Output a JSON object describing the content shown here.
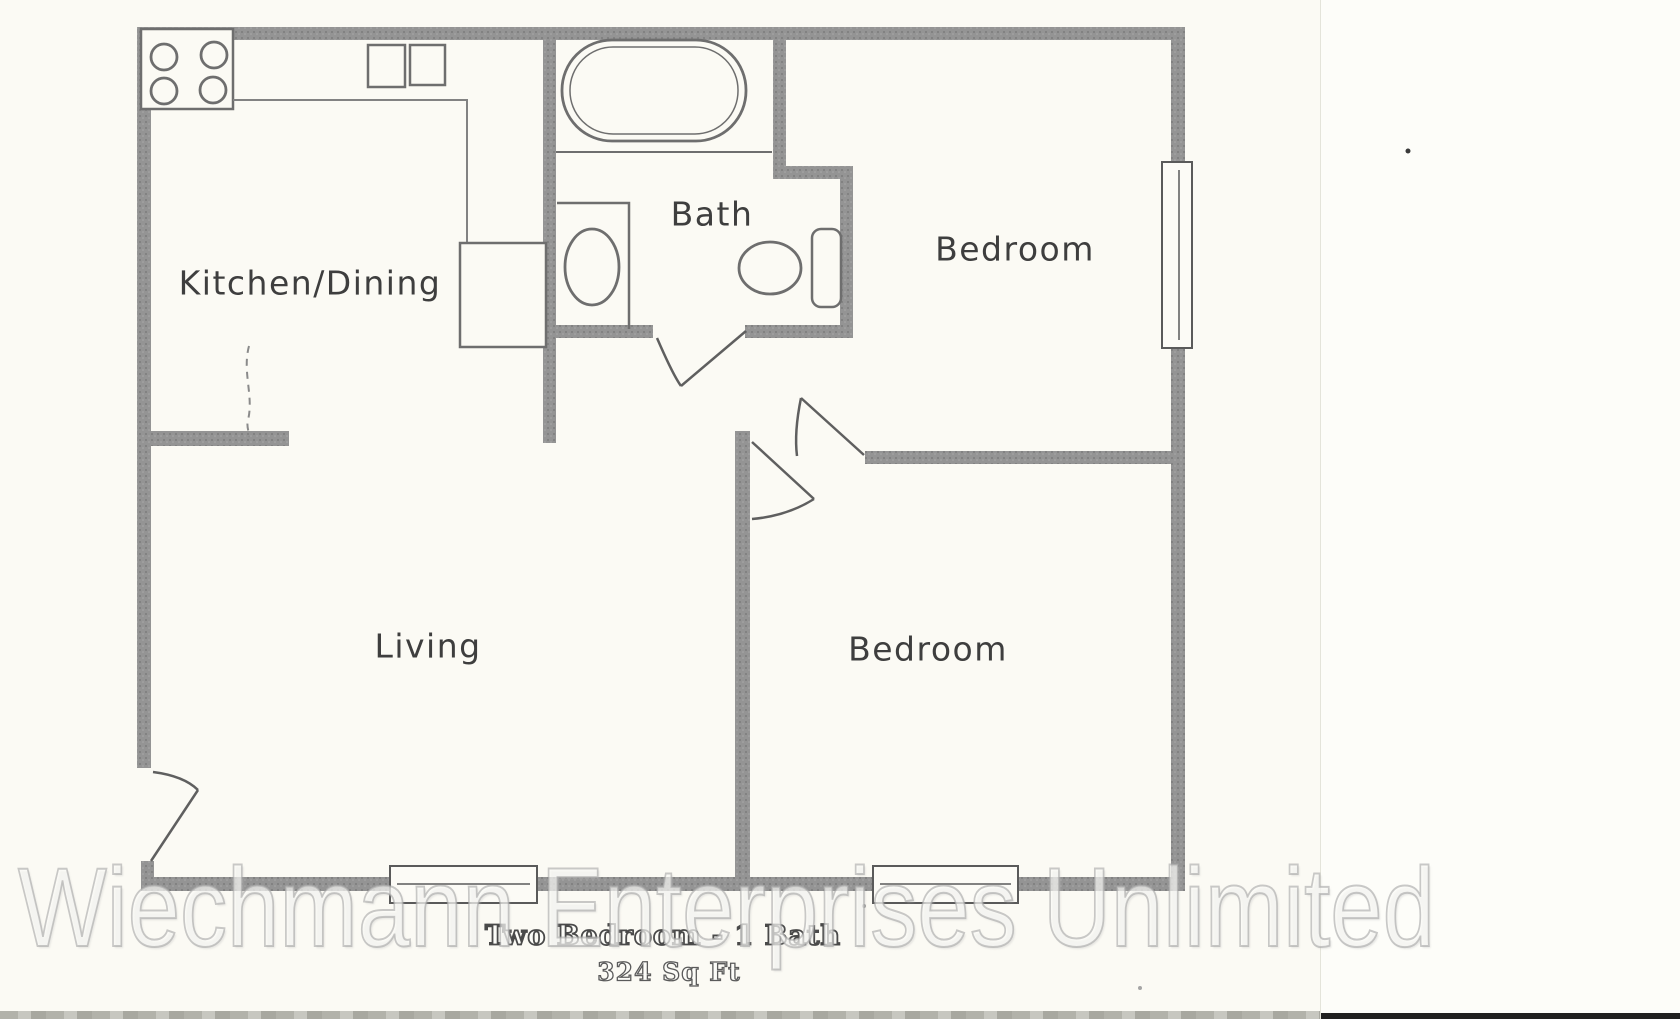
{
  "scan": {
    "caption_title": "Two Bedroom - 1 Bath",
    "caption_area": "324 Sq Ft",
    "watermark": "Wiechmann Enterprises Unlimited",
    "rooms": [
      {
        "id": "kitchen-dining",
        "label": "Kitchen/Dining"
      },
      {
        "id": "bath",
        "label": "Bath"
      },
      {
        "id": "bedroom-1",
        "label": "Bedroom"
      },
      {
        "id": "living",
        "label": "Living"
      },
      {
        "id": "bedroom-2",
        "label": "Bedroom"
      }
    ],
    "fixtures": [
      "stove-icon",
      "kitchen-sink-icon",
      "refrigerator-icon",
      "bathtub-icon",
      "vanity-sink-icon",
      "toilet-icon"
    ],
    "features": [
      "right-wall-window",
      "bottom-wall-window-left",
      "bottom-wall-window-right",
      "entry-door",
      "bath-door",
      "bedroom-1-door",
      "bedroom-2-door"
    ],
    "colors": {
      "paper": "#fbfaf4",
      "wall": "#8f8f8f",
      "fixture_line": "#6e6e6e",
      "caption_ink": "#4a4a4a",
      "watermark_stroke": "#a8a8a8"
    }
  }
}
